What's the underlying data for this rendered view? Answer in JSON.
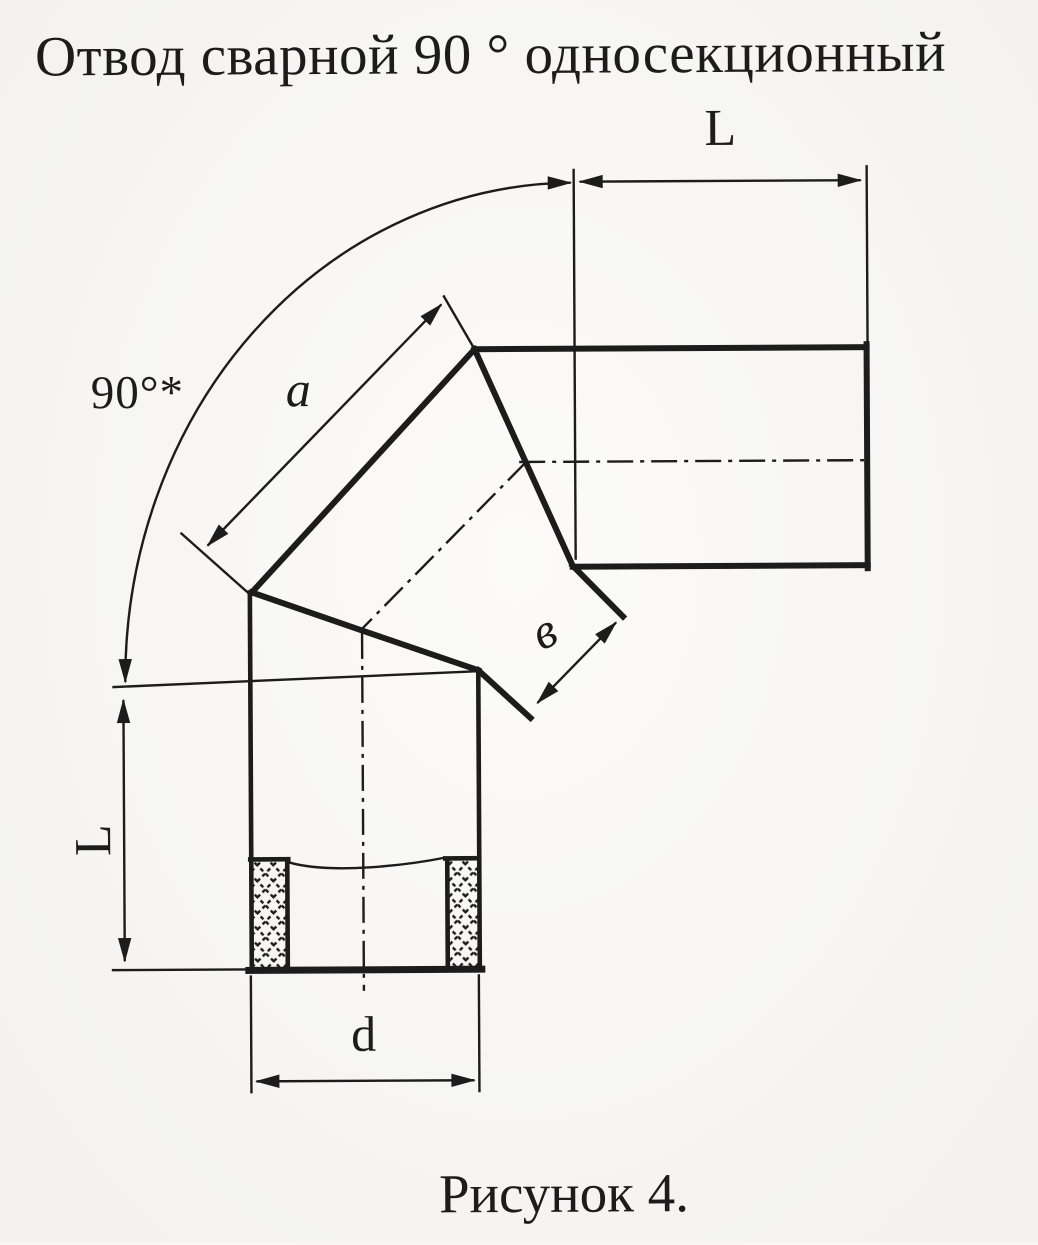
{
  "title": "Отвод сварной 90 ° односекционный",
  "caption": "Рисунок 4.",
  "labels": {
    "length_top": "L",
    "length_left": "L",
    "angle": "90°*",
    "side_a": "a",
    "end_width_v": "в",
    "diameter_d": "d"
  },
  "colors": {
    "ink": "#1c1c1c",
    "paper": "#f8f7f4"
  }
}
